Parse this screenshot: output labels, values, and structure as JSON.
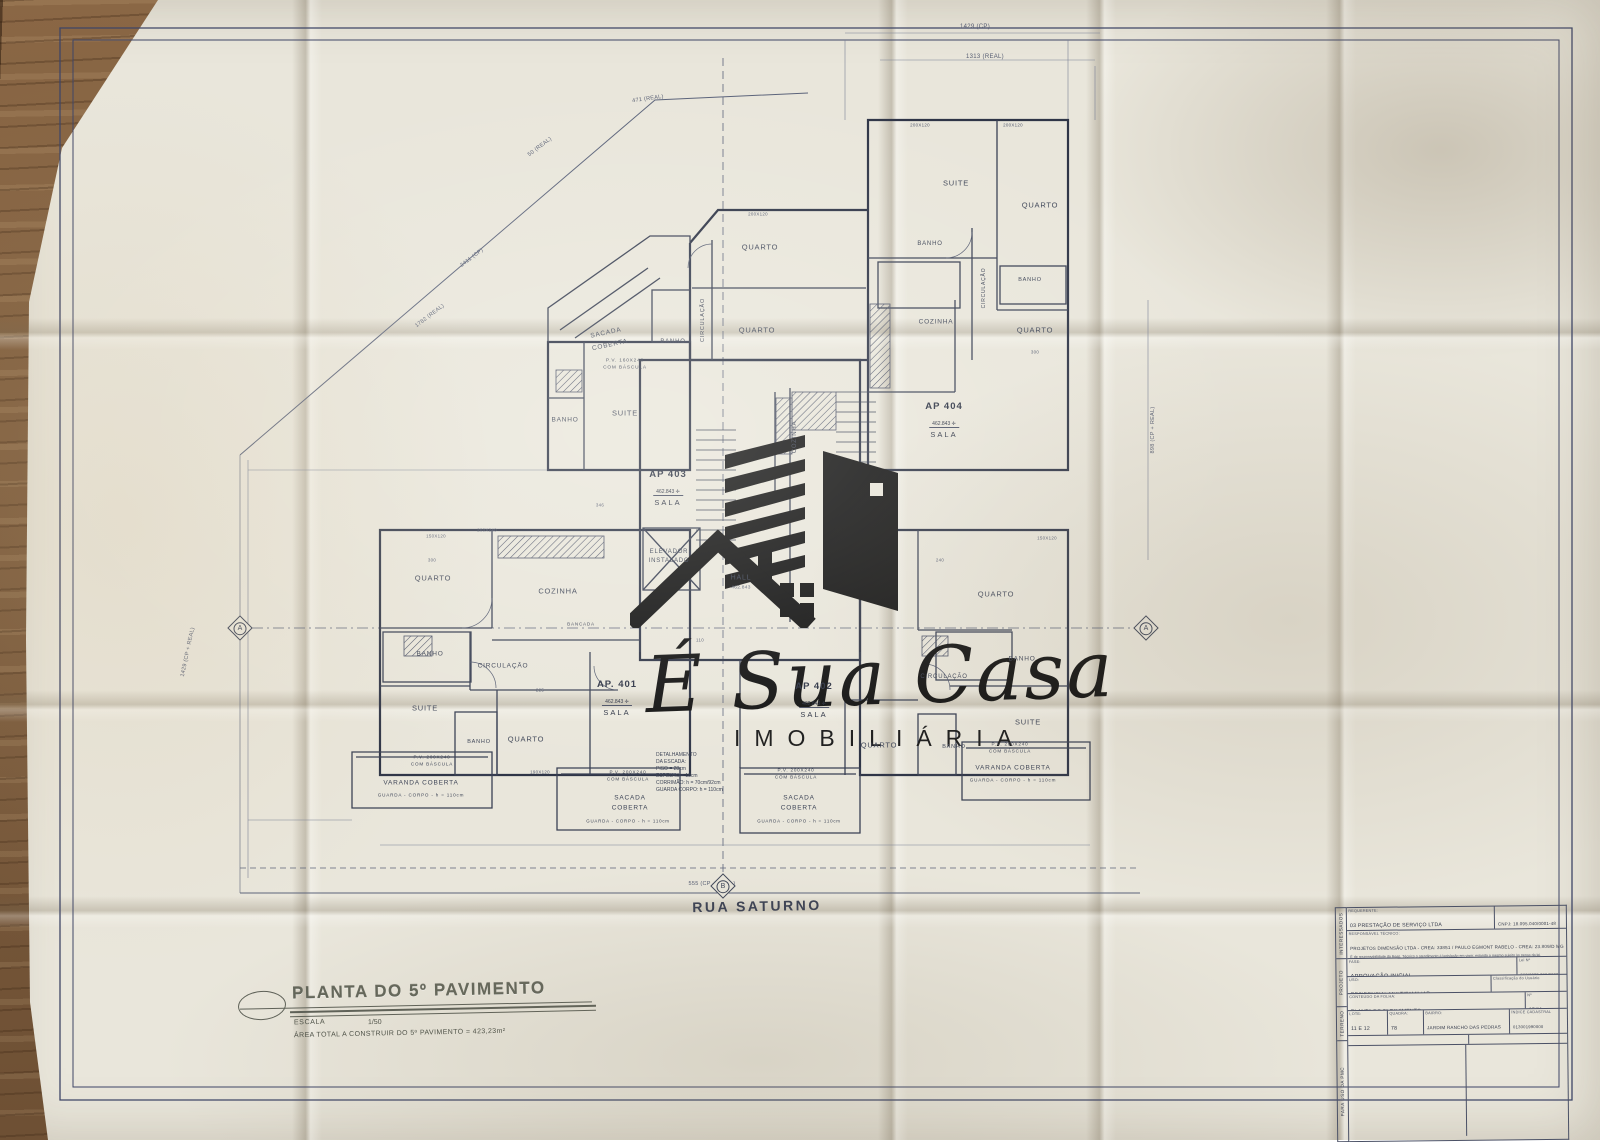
{
  "street_label": "RUA SATURNO",
  "watermark": {
    "script": "É Sua Casa",
    "subtitle": "IMOBILIÁRIA"
  },
  "stamp": {
    "title": "PLANTA DO 5º PAVIMENTO",
    "scale_label": "ESCALA",
    "scale_value": "1/50",
    "area_note": "ÁREA TOTAL A CONSTRUIR DO 5º PAVIMENTO = 423,23m²"
  },
  "plan": {
    "rooms": [
      {
        "t": "QUARTO",
        "x": 760,
        "y": 247
      },
      {
        "t": "QUARTO",
        "x": 757,
        "y": 330
      },
      {
        "t": "CIRCULAÇÃO",
        "x": 703,
        "y": 320,
        "r": -90,
        "s": 5.5
      },
      {
        "t": "SACADA",
        "x": 606,
        "y": 333,
        "r": -12,
        "s": 6.5
      },
      {
        "t": "COBERTA",
        "x": 610,
        "y": 345,
        "r": -12,
        "s": 6.5
      },
      {
        "t": "BANHO",
        "x": 673,
        "y": 342,
        "s": 6
      },
      {
        "t": "P.V. 160X240",
        "x": 625,
        "y": 361,
        "s": 4.8
      },
      {
        "t": "COM BÁSCULA",
        "x": 625,
        "y": 368,
        "s": 4.8
      },
      {
        "t": "BANHO",
        "x": 565,
        "y": 420,
        "s": 6.5
      },
      {
        "t": "SUITE",
        "x": 625,
        "y": 413
      },
      {
        "t": "SUITE",
        "x": 956,
        "y": 183
      },
      {
        "t": "QUARTO",
        "x": 1040,
        "y": 205
      },
      {
        "t": "BANHO",
        "x": 930,
        "y": 244,
        "s": 6
      },
      {
        "t": "CIRCULAÇÃO",
        "x": 984,
        "y": 288,
        "r": -90,
        "s": 5
      },
      {
        "t": "BANHO",
        "x": 1030,
        "y": 280,
        "s": 5.5
      },
      {
        "t": "QUARTO",
        "x": 1035,
        "y": 330
      },
      {
        "t": "COZINHA",
        "x": 936,
        "y": 322,
        "s": 6.5
      },
      {
        "t": "COZINHA",
        "x": 795,
        "y": 437,
        "r": -90,
        "s": 6
      },
      {
        "t": "ELEVADOR",
        "x": 669,
        "y": 552,
        "s": 6
      },
      {
        "t": "INSTALADO",
        "x": 669,
        "y": 561,
        "s": 6
      },
      {
        "t": "HALL",
        "x": 741,
        "y": 578,
        "s": 7
      },
      {
        "t": "QUARTO",
        "x": 433,
        "y": 578
      },
      {
        "t": "COZINHA",
        "x": 558,
        "y": 591
      },
      {
        "t": "BANCADA",
        "x": 581,
        "y": 624,
        "s": 4.6
      },
      {
        "t": "BANHO",
        "x": 430,
        "y": 654,
        "s": 6.5
      },
      {
        "t": "CIRCULAÇÃO",
        "x": 503,
        "y": 666,
        "s": 6.5
      },
      {
        "t": "SUITE",
        "x": 425,
        "y": 708
      },
      {
        "t": "BANHO",
        "x": 479,
        "y": 742,
        "s": 5.5
      },
      {
        "t": "QUARTO",
        "x": 526,
        "y": 739
      },
      {
        "t": "QUARTO",
        "x": 996,
        "y": 594
      },
      {
        "t": "BANHO",
        "x": 1022,
        "y": 659,
        "s": 6.5
      },
      {
        "t": "CIRCULAÇÃO",
        "x": 944,
        "y": 677,
        "s": 6
      },
      {
        "t": "SUITE",
        "x": 1028,
        "y": 722
      },
      {
        "t": "BANHO",
        "x": 954,
        "y": 747,
        "s": 5.5
      },
      {
        "t": "QUARTO",
        "x": 879,
        "y": 745
      },
      {
        "t": "VARANDA COBERTA",
        "x": 421,
        "y": 783,
        "s": 6.5
      },
      {
        "t": "GUARDA - CORPO - h = 110cm",
        "x": 421,
        "y": 795,
        "s": 4.6
      },
      {
        "t": "P.V. 200X240",
        "x": 432,
        "y": 757,
        "s": 4.6
      },
      {
        "t": "COM BÁSCULA",
        "x": 432,
        "y": 764,
        "s": 4.6
      },
      {
        "t": "SACADA",
        "x": 630,
        "y": 798,
        "s": 6.5
      },
      {
        "t": "COBERTA",
        "x": 630,
        "y": 808,
        "s": 6.5
      },
      {
        "t": "GUARDA - CORPO - h = 110cm",
        "x": 628,
        "y": 821,
        "s": 4.4
      },
      {
        "t": "P.V. 200X240",
        "x": 628,
        "y": 772,
        "s": 4.6
      },
      {
        "t": "COM BÁSCULA",
        "x": 628,
        "y": 779,
        "s": 4.6
      },
      {
        "t": "SACADA",
        "x": 799,
        "y": 798,
        "s": 6.5
      },
      {
        "t": "COBERTA",
        "x": 799,
        "y": 808,
        "s": 6.5
      },
      {
        "t": "GUARDA - CORPO - h = 110cm",
        "x": 799,
        "y": 821,
        "s": 4.4
      },
      {
        "t": "P.V. 200X240",
        "x": 796,
        "y": 770,
        "s": 4.6
      },
      {
        "t": "COM BÁSCULA",
        "x": 796,
        "y": 777,
        "s": 4.6
      },
      {
        "t": "VARANDA COBERTA",
        "x": 1013,
        "y": 768,
        "s": 6.5
      },
      {
        "t": "GUARDA - CORPO - h = 110cm",
        "x": 1013,
        "y": 780,
        "s": 4.6
      },
      {
        "t": "P.V. 200X240",
        "x": 1010,
        "y": 744,
        "s": 4.6
      },
      {
        "t": "COM BÁSCULA",
        "x": 1010,
        "y": 751,
        "s": 4.6
      }
    ],
    "dimensions": [
      {
        "t": "1429 (CP)",
        "x": 975,
        "y": 27,
        "s": 6
      },
      {
        "t": "1313 (REAL)",
        "x": 985,
        "y": 57,
        "s": 6
      },
      {
        "t": "471 (REAL)",
        "x": 648,
        "y": 99,
        "r": -8,
        "s": 5.5
      },
      {
        "t": "50 (REAL)",
        "x": 540,
        "y": 147,
        "r": -37,
        "s": 5.5
      },
      {
        "t": "2411 (CP)",
        "x": 472,
        "y": 258,
        "r": -37,
        "s": 5.5
      },
      {
        "t": "1782 (REAL)",
        "x": 430,
        "y": 316,
        "r": -37,
        "s": 5.5
      },
      {
        "t": "1429 (CP + REAL)",
        "x": 188,
        "y": 652,
        "r": -78,
        "s": 5.5
      },
      {
        "t": "898 (CP + REAL)",
        "x": 1153,
        "y": 430,
        "r": -90,
        "s": 5.5
      },
      {
        "t": "555 (CP + REAL)",
        "x": 712,
        "y": 884,
        "s": 5.5
      },
      {
        "t": "462.843",
        "x": 741,
        "y": 588,
        "s": 4.8
      },
      {
        "t": "200X120",
        "x": 758,
        "y": 214,
        "s": 4.4
      },
      {
        "t": "200X120",
        "x": 920,
        "y": 125,
        "s": 4.4
      },
      {
        "t": "200X120",
        "x": 1013,
        "y": 125,
        "s": 4.4
      },
      {
        "t": "150X120",
        "x": 436,
        "y": 536,
        "s": 4.4
      },
      {
        "t": "200X240",
        "x": 487,
        "y": 530,
        "s": 4.4
      },
      {
        "t": "190X120",
        "x": 540,
        "y": 772,
        "s": 4.4
      },
      {
        "t": "150X120",
        "x": 1047,
        "y": 538,
        "s": 4.4
      },
      {
        "t": "300",
        "x": 432,
        "y": 560,
        "s": 4.4
      },
      {
        "t": "346",
        "x": 600,
        "y": 505,
        "s": 4.4
      },
      {
        "t": "240",
        "x": 940,
        "y": 560,
        "s": 4.4
      },
      {
        "t": "225",
        "x": 540,
        "y": 690,
        "s": 4.4
      },
      {
        "t": "110",
        "x": 700,
        "y": 640,
        "s": 4.4
      },
      {
        "t": "300",
        "x": 1035,
        "y": 352,
        "s": 4.4
      }
    ],
    "apartments": [
      {
        "n": "AP 403",
        "e": "462.843",
        "r": "SALA",
        "x": 668,
        "y": 488
      },
      {
        "n": "AP 404",
        "e": "462.843",
        "r": "SALA",
        "x": 944,
        "y": 420
      },
      {
        "n": "AP. 401",
        "e": "462.843",
        "r": "SALA",
        "x": 617,
        "y": 698
      },
      {
        "n": "AP 402",
        "e": "462.843",
        "r": "SALA",
        "x": 814,
        "y": 700
      }
    ],
    "markers": [
      {
        "t": "A",
        "x": 240,
        "y": 628
      },
      {
        "t": "A",
        "x": 1146,
        "y": 628
      },
      {
        "t": "B",
        "x": 723,
        "y": 886
      }
    ],
    "stair_detail": {
      "x": 656,
      "y": 752,
      "lines": [
        "DETALHAMENTO",
        "DA ESCADA:",
        "PISO = 28cm",
        "ESPELHO = 18cm",
        "CORRIMÃO: h = 70cm/92cm",
        "GUARDA CORPO: h = 110cm"
      ]
    }
  },
  "title_block": {
    "side_labels": [
      "INTERESSADOS",
      "PROJETO",
      "TERRENO",
      "PARA USO DA PMC"
    ],
    "requerente_caption": "REQUERENTE:",
    "requerente": "03 PRESTAÇÃO DE SERVIÇO LTDA",
    "cnpj": "CNPJ: 18.095.040/0001-48",
    "resp_caption": "RESPONSÁVEL TÉCNICO:",
    "resp": "PROJETOS DIMENSÃO LTDA - CREA: 33851 / PAULO EGMONT RABELO - CREA: 23.809/D MG",
    "resp_note": "É de responsabilidade do Resp. Técnico o atendimento à legislação em vigor, estando o mesmo sujeito às penas da lei.",
    "fase_caption": "FASE:",
    "fase": "APROVAÇÃO INICIAL",
    "lei_caption": "Lei Nº",
    "lei_values": "562/2023 299/2023",
    "uso_caption": "USO:",
    "uso": "RESIDENCIAL MULTIFAMILIAR",
    "classificacao_caption": "Classificação do Usuário",
    "conteudo_caption": "CONTEÚDO DA FOLHA:",
    "conteudo": "PLANTA DO 5º PAVIMENTO",
    "folha_caption": "Nº",
    "folha": "05/11",
    "lote_caption": "LOTE:",
    "lote": "11 E 12",
    "quadra_caption": "QUADRA:",
    "quadra": "78",
    "bairro_caption": "BAIRRO:",
    "bairro": "JARDIM RANCHO DAS PEDRAS",
    "indice_caption": "ÍNDICE CADASTRAL",
    "indice": "013001990000 013001992000",
    "obs_caption": "OBSERVAÇÕES",
    "topo_caption": "USO/FOTO/TOPOGRAFIA"
  },
  "colors": {
    "paper": "#e9e6db",
    "line": "#454c60",
    "wall": "#2f3547",
    "wood": "#7d5c3d",
    "logo": "#131313"
  }
}
